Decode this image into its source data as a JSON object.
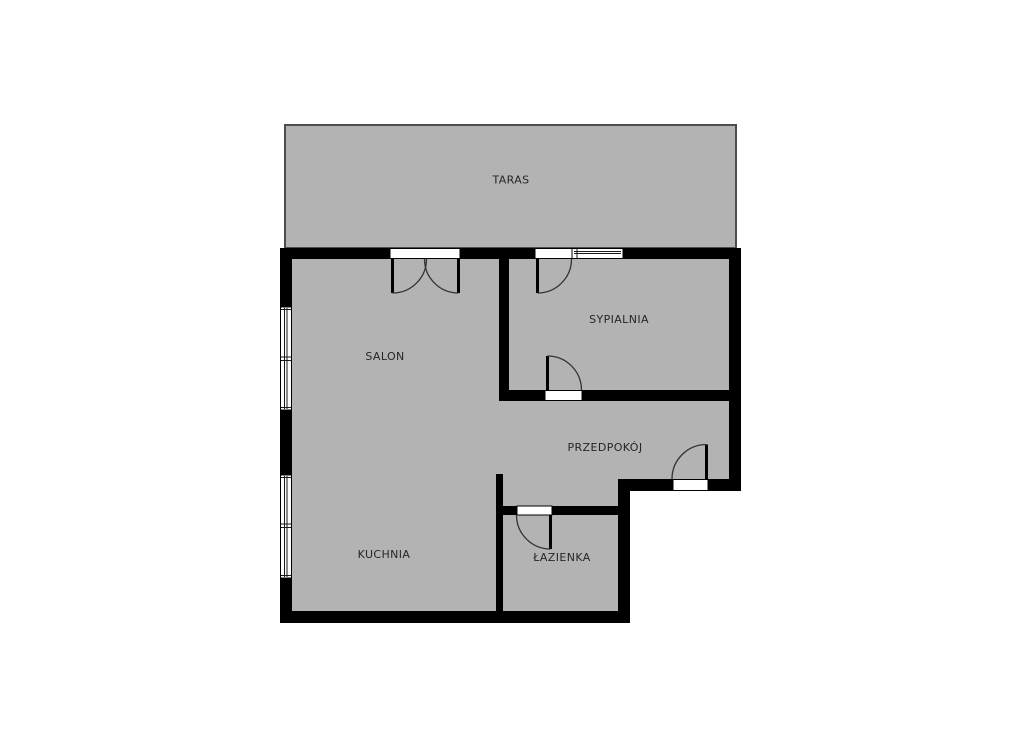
{
  "floorplan": {
    "rooms": {
      "taras": {
        "label": "TARAS"
      },
      "salon": {
        "label": "SALON"
      },
      "sypialnia": {
        "label": "SYPIALNIA"
      },
      "przedpokoj": {
        "label": "PRZEDPOKÓJ"
      },
      "kuchnia": {
        "label": "KUCHNIA"
      },
      "lazienka": {
        "label": "ŁAZIENKA"
      }
    },
    "colors": {
      "background": "#ffffff",
      "floor": "#b3b3b3",
      "wall": "#000000",
      "terrace_outline": "#4d4d4d",
      "label": "#262626"
    }
  }
}
